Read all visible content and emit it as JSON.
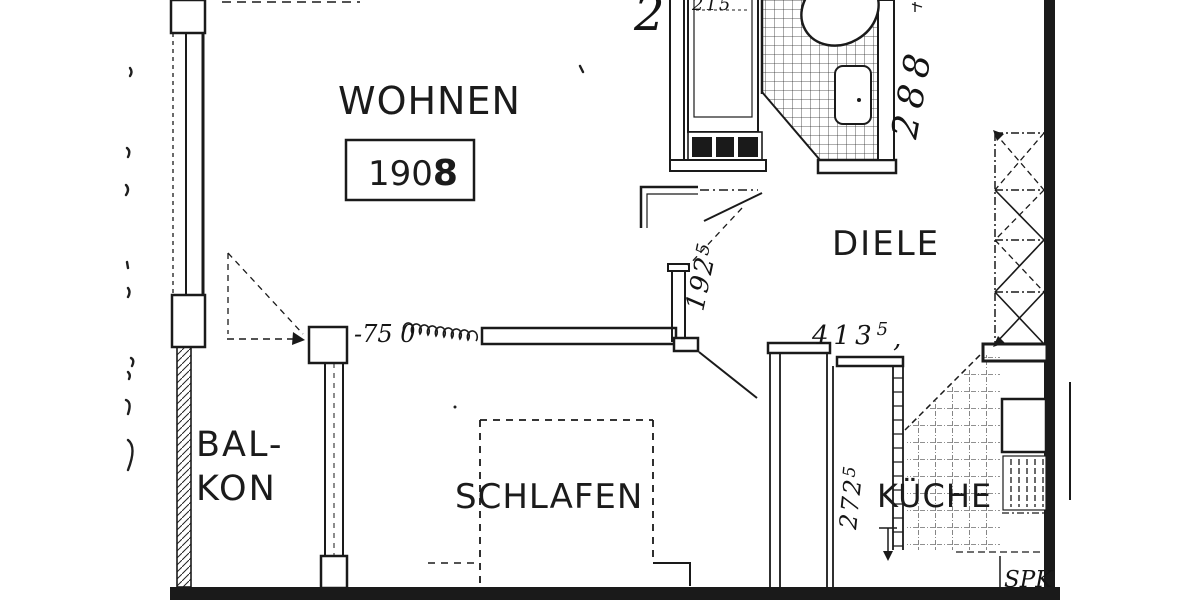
{
  "colors": {
    "ink": "#1a1a1a",
    "paper": "#ffffff"
  },
  "rooms": {
    "wohnen": {
      "label": "WOHNEN",
      "number": "190",
      "number_bold": "8"
    },
    "diele": {
      "label": "DIELE"
    },
    "balkon": {
      "line1": "BAL-",
      "line2": "KON"
    },
    "schlafen": {
      "label": "SCHLAFEN"
    },
    "kueche": {
      "label": "KÜCHE"
    },
    "spk": {
      "label": "SPK"
    }
  },
  "dims": {
    "storey": "2",
    "unit_width": "215",
    "bath_height": "288",
    "niche_height": {
      "main": "192",
      "sup": "5"
    },
    "hall_width": {
      "main": "413",
      "sup": "5",
      "tail": ","
    },
    "kitchen_height": {
      "main": "272",
      "sup": "5"
    },
    "wall_note": "-75 0"
  }
}
